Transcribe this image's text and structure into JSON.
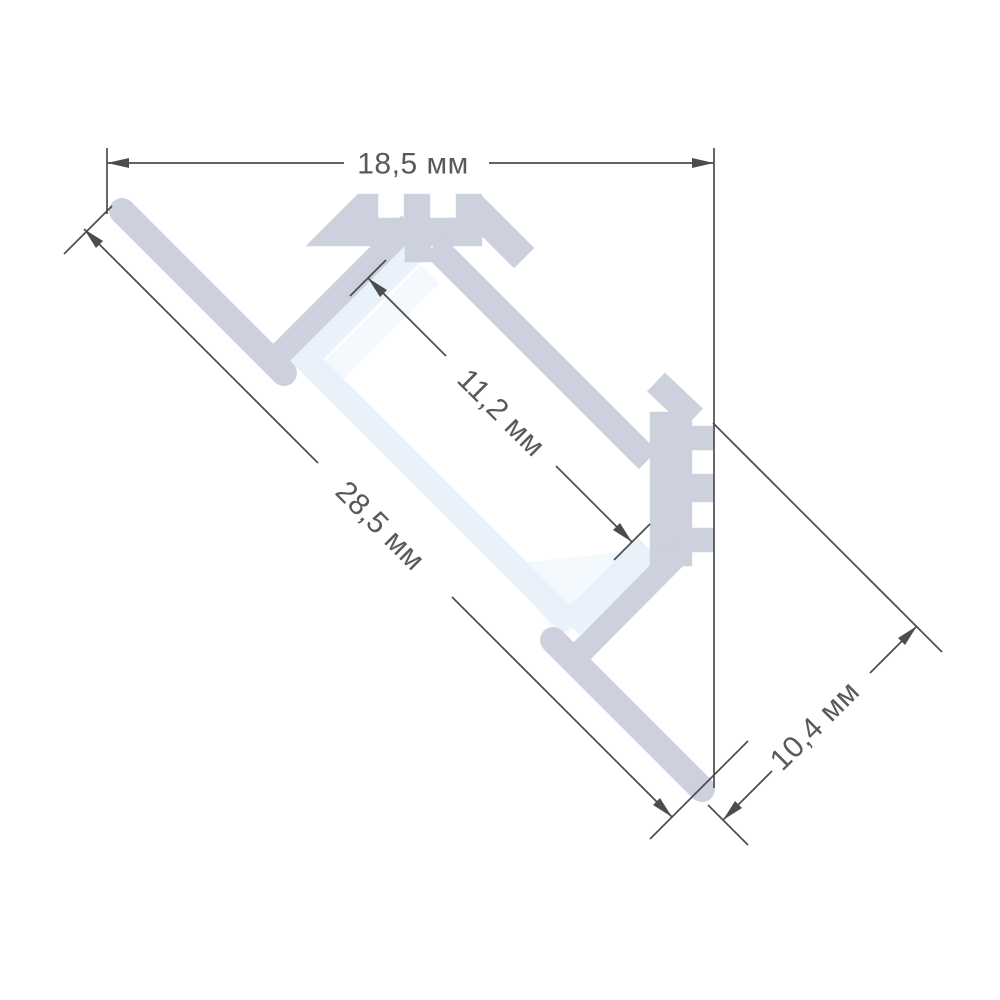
{
  "drawing": {
    "kind": "profile-cross-section",
    "labels": {
      "width_top": "18,5 мм",
      "opening_width": "11,2 мм",
      "side_length": "28,5 мм",
      "back_height": "10,4 мм"
    },
    "colors": {
      "aluminum": "#ccd1dd",
      "diffuser": "#e9f1fa",
      "diffuser_light": "#f4f9fd",
      "dimension": "#4b4c4e",
      "text": "#58595b",
      "background": "#ffffff"
    }
  }
}
